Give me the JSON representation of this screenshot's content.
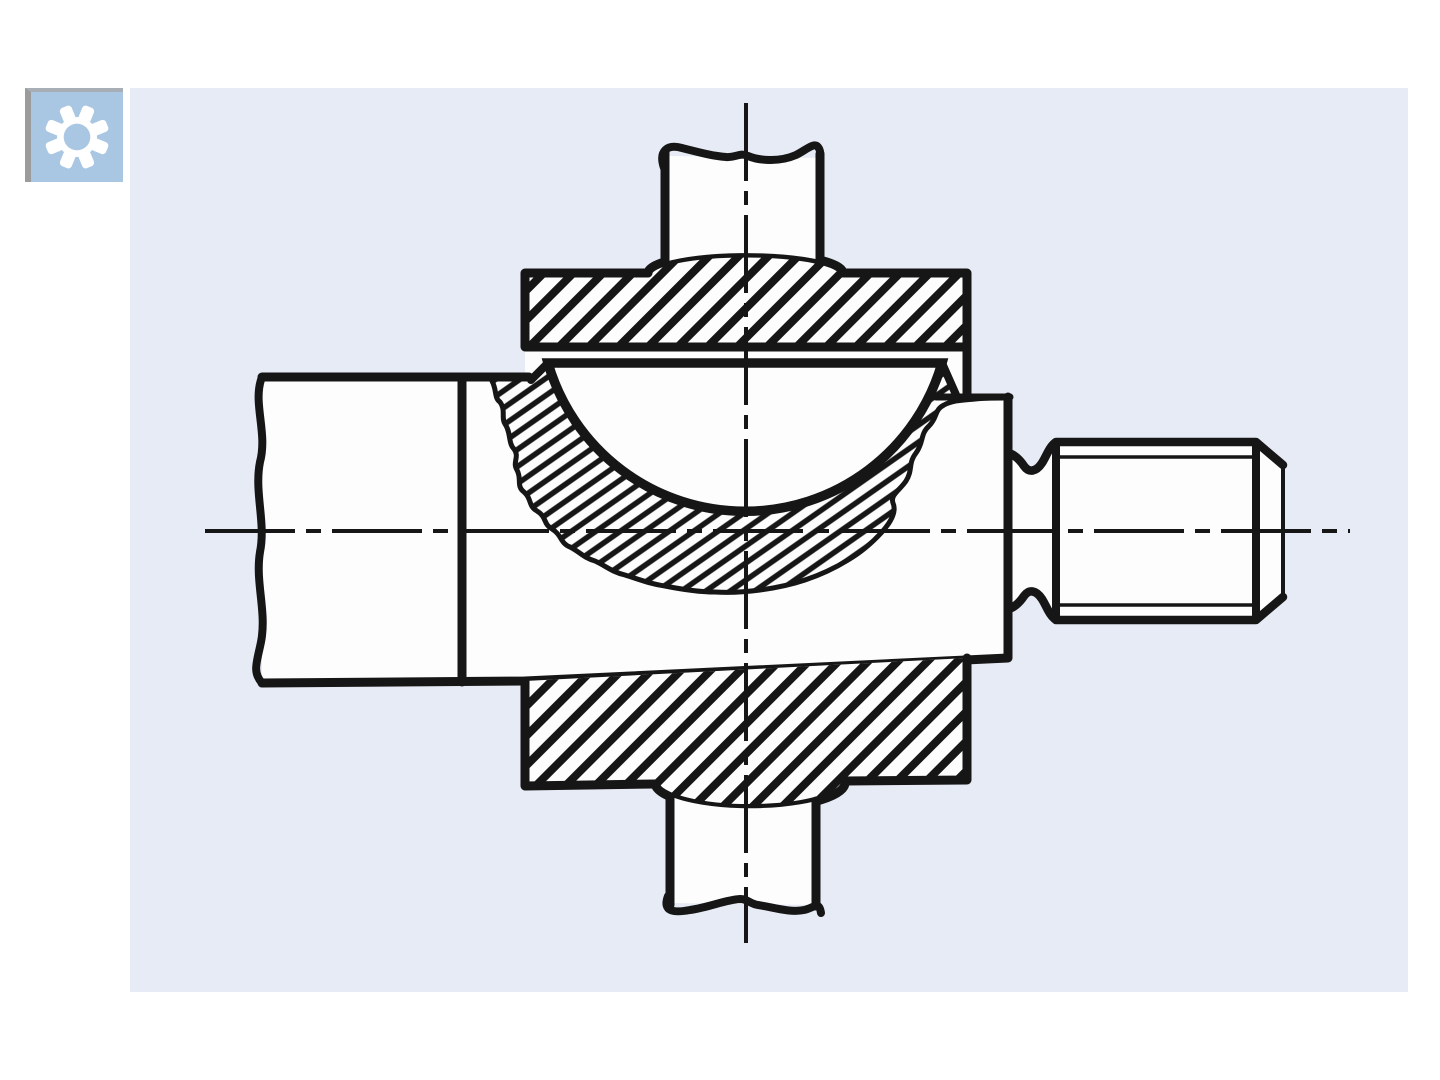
{
  "window": {
    "width": 1440,
    "height": 1080,
    "background": "#ffffff"
  },
  "panel": {
    "background": "#e7ebf5"
  },
  "badge": {
    "background": "#a9c6e2",
    "edge": "#9b9b9b",
    "icon": "gear-icon",
    "icon_color": "#ffffff"
  },
  "drawing": {
    "type": "technical-section-drawing",
    "line_color": "#161616",
    "fill_color": "#fdfdfd",
    "hatch_color": "#161616",
    "description": "Cross-section of a spherical-seat clamping assembly: horizontal shaft with break line at left, clamp body with broken-out section around a spherical dome seat, vertical pin with break lines passing through two hatched clamping plates, and a threaded stud with chamfered end at right; dash-dot centerlines through both axes.",
    "features": [
      "left-shaft-with-break-line",
      "clamp-body",
      "upper-clamping-plate-hatched",
      "lower-clamping-plate-hatched",
      "spherical-dome-seat",
      "broken-out-section-fine-hatch",
      "vertical-pin-top-with-break-line",
      "vertical-pin-bottom-with-break-line",
      "threaded-stud-with-chamfer",
      "horizontal-centerline",
      "vertical-centerline"
    ]
  }
}
